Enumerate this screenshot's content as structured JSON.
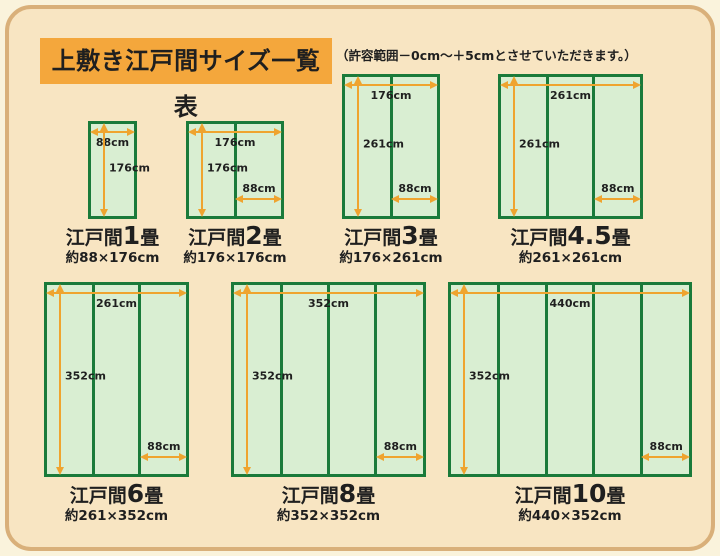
{
  "page": {
    "title": "上敷き江戸間サイズ一覧表",
    "note": "（許容範囲－0cm～＋5cmとさせていただきます。）"
  },
  "colors": {
    "page_background": "#faf3dc",
    "panel_fill": "#f8e5c2",
    "panel_border": "#d9b07a",
    "title_background": "#f4a73c",
    "mat_fill": "#d9eed2",
    "mat_border": "#1a7a3a",
    "arrow": "#efa42f",
    "text": "#1f1f1f"
  },
  "chart_data": {
    "type": "table",
    "title": "上敷き江戸間サイズ一覧表",
    "note": "（許容範囲－0cm～＋5cmとさせていただきます。）",
    "unit": "cm",
    "mats": [
      {
        "name_prefix": "江戸間",
        "name_num": "1",
        "name_suffix": "畳",
        "size_label": "約88×176cm",
        "width_cm": 88,
        "height_cm": 176,
        "panels": 1,
        "top_label": "88cm",
        "side_label": "176cm",
        "bottom_label": null
      },
      {
        "name_prefix": "江戸間",
        "name_num": "2",
        "name_suffix": "畳",
        "size_label": "約176×176cm",
        "width_cm": 176,
        "height_cm": 176,
        "panels": 2,
        "top_label": "176cm",
        "side_label": "176cm",
        "bottom_label": "88cm"
      },
      {
        "name_prefix": "江戸間",
        "name_num": "3",
        "name_suffix": "畳",
        "size_label": "約176×261cm",
        "width_cm": 176,
        "height_cm": 261,
        "panels": 2,
        "top_label": "176cm",
        "side_label": "261cm",
        "bottom_label": "88cm"
      },
      {
        "name_prefix": "江戸間",
        "name_num": "4.5",
        "name_suffix": "畳",
        "size_label": "約261×261cm",
        "width_cm": 261,
        "height_cm": 261,
        "panels": 3,
        "top_label": "261cm",
        "side_label": "261cm",
        "bottom_label": "88cm"
      },
      {
        "name_prefix": "江戸間",
        "name_num": "6",
        "name_suffix": "畳",
        "size_label": "約261×352cm",
        "width_cm": 261,
        "height_cm": 352,
        "panels": 3,
        "top_label": "261cm",
        "side_label": "352cm",
        "bottom_label": "88cm"
      },
      {
        "name_prefix": "江戸間",
        "name_num": "8",
        "name_suffix": "畳",
        "size_label": "約352×352cm",
        "width_cm": 352,
        "height_cm": 352,
        "panels": 4,
        "top_label": "352cm",
        "side_label": "352cm",
        "bottom_label": "88cm"
      },
      {
        "name_prefix": "江戸間",
        "name_num": "10",
        "name_suffix": "畳",
        "size_label": "約440×352cm",
        "width_cm": 440,
        "height_cm": 352,
        "panels": 5,
        "top_label": "440cm",
        "side_label": "352cm",
        "bottom_label": "88cm"
      }
    ]
  }
}
